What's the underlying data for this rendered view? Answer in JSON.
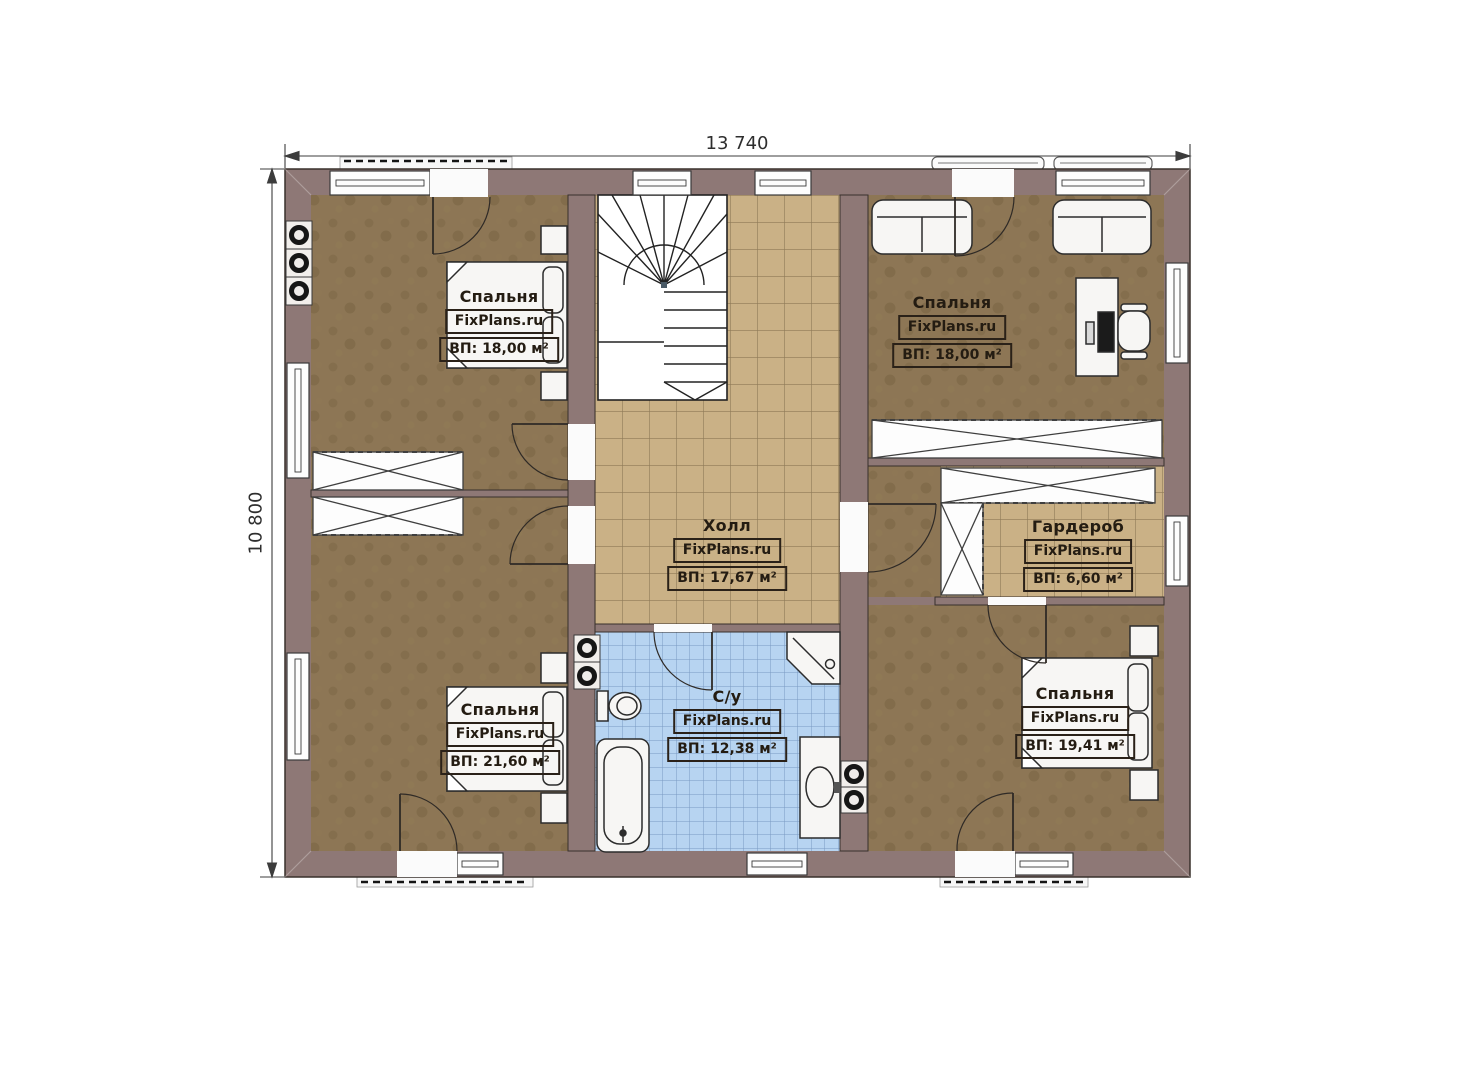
{
  "plan": {
    "dimensions": {
      "width": "13 740",
      "height": "10 800"
    },
    "watermark": "FixPlans.ru",
    "rooms": [
      {
        "id": "bedroom-top-left",
        "name": "Спальня",
        "area": "ВП: 18,00 м²"
      },
      {
        "id": "bedroom-top-right",
        "name": "Спальня",
        "area": "ВП: 18,00 м²"
      },
      {
        "id": "hall",
        "name": "Холл",
        "area": "ВП: 17,67 м²"
      },
      {
        "id": "wardrobe",
        "name": "Гардероб",
        "area": "ВП: 6,60 м²"
      },
      {
        "id": "bedroom-bottom-left",
        "name": "Спальня",
        "area": "ВП: 21,60 м²"
      },
      {
        "id": "bathroom",
        "name": "С/у",
        "area": "ВП: 12,38 м²"
      },
      {
        "id": "bedroom-bottom-right",
        "name": "Спальня",
        "area": "ВП: 19,41 м²"
      }
    ],
    "colors": {
      "wall": "#8e7876",
      "bedroom_floor": "#8d7655",
      "tile_floor": "#cab186",
      "bath_tile": "#b7d4f1"
    }
  }
}
